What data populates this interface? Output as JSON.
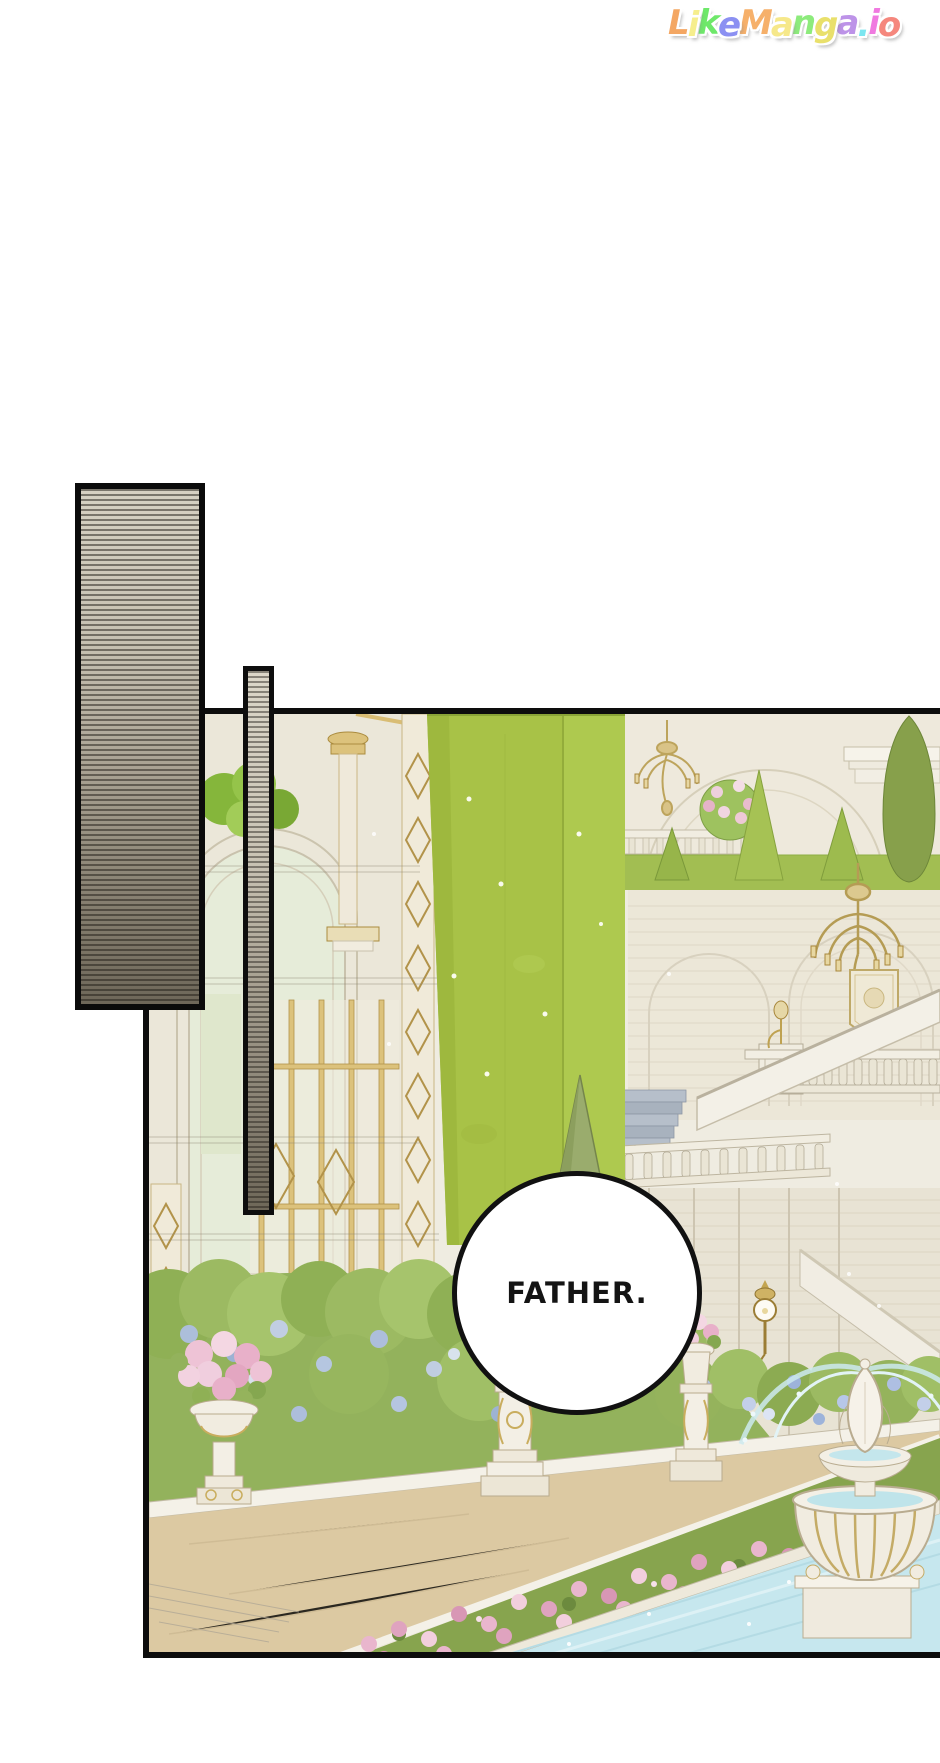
{
  "logo": {
    "text": "LikeManga.io",
    "letters": [
      {
        "ch": "L",
        "color": "#f4a763"
      },
      {
        "ch": "i",
        "color": "#f6ee8d"
      },
      {
        "ch": "k",
        "color": "#6ee86a"
      },
      {
        "ch": "e",
        "color": "#8b90f2"
      },
      {
        "ch": "M",
        "color": "#f6b06a"
      },
      {
        "ch": "a",
        "color": "#f6e88a"
      },
      {
        "ch": "n",
        "color": "#8deb7c"
      },
      {
        "ch": "g",
        "color": "#e9e06b"
      },
      {
        "ch": "a",
        "color": "#bd93e8"
      },
      {
        "ch": ".",
        "color": "#7ce6f0"
      },
      {
        "ch": "i",
        "color": "#f07ae0"
      },
      {
        "ch": "o",
        "color": "#f5877d"
      }
    ]
  },
  "speech_bubble": {
    "text": "FATHER."
  },
  "colors": {
    "panel_border": "#0d0d0d",
    "hedge_green": "#a8c247",
    "lawn_green": "#a2be52",
    "cypress_green": "#87a04b",
    "wall_cream": "#ece7d8",
    "gold_trim": "#d3b76a",
    "hydrangea_blue": "#aebfe2",
    "flower_pink": "#e9b6cd",
    "walkway_tan": "#dcc9a2",
    "pool_water": "#c6e7ee",
    "screentone_light": "#d6d1c3",
    "screentone_dark": "#6e6759"
  }
}
